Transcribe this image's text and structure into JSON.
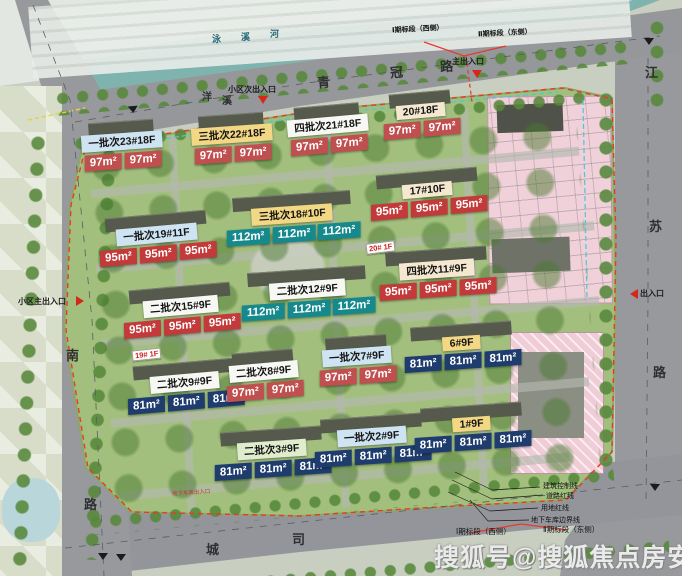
{
  "site": {
    "watermark": "搜狐号@搜狐焦点房安站",
    "boundary_color": "#e8392b"
  },
  "roads": {
    "top": {
      "name": "青冠路",
      "chars": [
        "青",
        "冠",
        "路"
      ]
    },
    "right": {
      "name": "江苏路",
      "chars": [
        "江",
        "苏",
        "路"
      ]
    },
    "left": {
      "name": "南路",
      "chars": [
        "南",
        "路"
      ]
    },
    "bottom": {
      "name": "城司路",
      "chars": [
        "城",
        "司"
      ]
    },
    "river": {
      "name": "泳溪河",
      "chars": [
        "泳",
        "溪",
        "河"
      ]
    },
    "junction": {
      "chars": [
        "洋",
        "溪"
      ]
    }
  },
  "entrances": {
    "secondary_top": "小区次出入口",
    "main_top": "主出入口",
    "main_left": "小区主出入口",
    "right": "出入口"
  },
  "phases": {
    "top_west": "Ⅰ期标段（西侧）",
    "top_east": "Ⅱ期标段（东侧）",
    "bottom_west": "Ⅰ期标段（西侧）",
    "bottom_east": "Ⅱ期标段（东侧）"
  },
  "legend": [
    "建筑控制线",
    "道路红线",
    "用地红线",
    "地下车库边界线"
  ],
  "notes": {
    "garage": "地下车库出入口",
    "tag_20": "20# 1F",
    "tag_19": "19# 1F"
  },
  "colors": {
    "red_tag": "#c23a3a",
    "pink_red_tag": "#c05050",
    "teal_tag": "#15898c",
    "navy_tag": "#1e3c6d",
    "plate_blue": "#cfe4f2",
    "plate_yellow": "#f2d784",
    "plate_cream": "#f5e8d0",
    "plate_white": "#f7f7f3",
    "plate_green": "#dfeccd",
    "boundary_red": "#e8392b",
    "river_teal": "#7fb3ae"
  },
  "buildings": [
    {
      "id": "b23",
      "name": "一批次23#18F",
      "plate": "#cfe4f2",
      "tag": "#c05050",
      "units": [
        "97m²",
        "97m²"
      ]
    },
    {
      "id": "b22",
      "name": "三批次22#18F",
      "plate": "#f2d784",
      "tag": "#c05050",
      "units": [
        "97m²",
        "97m²"
      ]
    },
    {
      "id": "b21",
      "name": "四批次21#18F",
      "plate": "#f7f7f3",
      "tag": "#c05050",
      "units": [
        "97m²",
        "97m²"
      ]
    },
    {
      "id": "b20",
      "name": "20#18F",
      "plate": "#f5e8d0",
      "tag": "#c05050",
      "units": [
        "97m²",
        "97m²"
      ]
    },
    {
      "id": "b17",
      "name": "17#10F",
      "plate": "#f5e8d0",
      "tag": "#c23a3a",
      "units": [
        "95m²",
        "95m²",
        "95m²"
      ]
    },
    {
      "id": "b18",
      "name": "三批次18#10F",
      "plate": "#f2d784",
      "tag": "#15898c",
      "units": [
        "112m²",
        "112m²",
        "112m²"
      ]
    },
    {
      "id": "b19",
      "name": "一批次19#11F",
      "plate": "#cfe4f2",
      "tag": "#c23a3a",
      "units": [
        "95m²",
        "95m²",
        "95m²"
      ]
    },
    {
      "id": "b11",
      "name": "四批次11#9F",
      "plate": "#f5e8d0",
      "tag": "#c23a3a",
      "units": [
        "95m²",
        "95m²",
        "95m²"
      ]
    },
    {
      "id": "b12",
      "name": "二批次12#9F",
      "plate": "#f7f7f3",
      "tag": "#15898c",
      "units": [
        "112m²",
        "112m²",
        "112m²"
      ]
    },
    {
      "id": "b15",
      "name": "二批次15#9F",
      "plate": "#f7f7f3",
      "tag": "#c23a3a",
      "units": [
        "95m²",
        "95m²",
        "95m²"
      ]
    },
    {
      "id": "b9",
      "name": "二批次9#9F",
      "plate": "#f7f7f3",
      "tag": "#1e3c6d",
      "units": [
        "81m²",
        "81m²",
        "81m²"
      ]
    },
    {
      "id": "b8",
      "name": "二批次8#9F",
      "plate": "#f7f7f3",
      "tag": "#c05050",
      "units": [
        "97m²",
        "97m²"
      ]
    },
    {
      "id": "b7",
      "name": "一批次7#9F",
      "plate": "#cfe4f2",
      "tag": "#c05050",
      "units": [
        "97m²",
        "97m²"
      ]
    },
    {
      "id": "b6",
      "name": "6#9F",
      "plate": "#f2d784",
      "tag": "#1e3c6d",
      "units": [
        "81m²",
        "81m²",
        "81m²"
      ]
    },
    {
      "id": "b3",
      "name": "二批次3#9F",
      "plate": "#dfeccd",
      "tag": "#1e3c6d",
      "units": [
        "81m²",
        "81m²",
        "81m²"
      ]
    },
    {
      "id": "b2",
      "name": "一批次2#9F",
      "plate": "#cfe4f2",
      "tag": "#1e3c6d",
      "units": [
        "81m²",
        "81m²",
        "81m²"
      ]
    },
    {
      "id": "b1",
      "name": "1#9F",
      "plate": "#f2d784",
      "tag": "#1e3c6d",
      "units": [
        "81m²",
        "81m²",
        "81m²"
      ]
    }
  ]
}
